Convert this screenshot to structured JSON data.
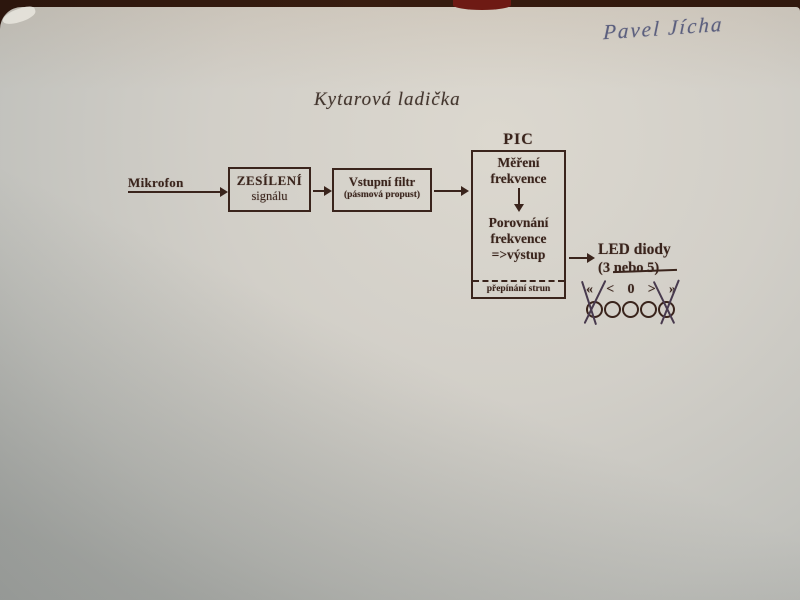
{
  "photo": {
    "table_color": "#32190d",
    "paper_color": "#d2cfc8",
    "red_object_color": "#6e1a14",
    "print_ink": "#3a241c",
    "pen_ink": "#5b5f7e"
  },
  "handwritten_name": "Pavel Jícha",
  "title": "Kytarová ladička",
  "diagram": {
    "mikrofon": "Mikrofon",
    "amplifier_box": {
      "line1": "ZESÍLENÍ",
      "line2": "signálu"
    },
    "filter_box": {
      "line1": "Vstupní filtr",
      "line2": "(pásmová propust)"
    },
    "pic_label": "PIC",
    "pic_box": {
      "measure_line1": "Měření",
      "measure_line2": "frekvence",
      "compare_line1": "Porovnání",
      "compare_line2": "frekvence",
      "compare_line3": "=>výstup",
      "footer": "přepínání strun"
    },
    "led": {
      "title": "LED diody",
      "count_prefix": "(3",
      "count_struck": "nebo 5",
      "count_suffix": ")",
      "symbols": [
        "«",
        "<",
        "0",
        ">",
        "»"
      ],
      "led_count": 5
    }
  }
}
